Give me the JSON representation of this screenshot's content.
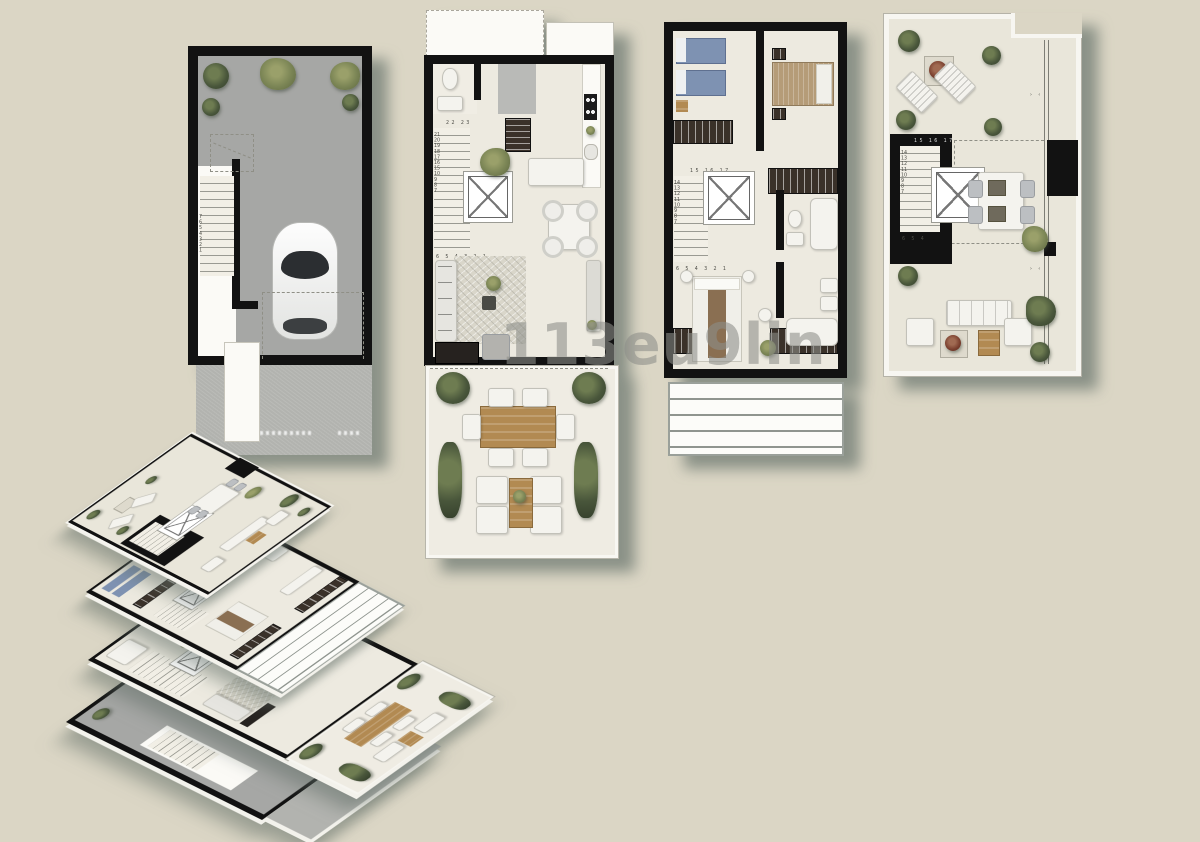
{
  "title": "townhouse-floor-plans",
  "watermark": {
    "text": "113eu9lin"
  },
  "colors": {
    "background": "#dbd6c5",
    "walls": "#121212",
    "floor": "#edeae0",
    "garage_floor": "#a6a7a5",
    "driveway": "#b2b3af",
    "shadow": "#5f6e68",
    "bed_blue": "#7e92b2",
    "bed_tan": "#b59c78",
    "wood": "#b28a52",
    "plant_dark": "#49563b",
    "terrace_floor": "#efece3"
  },
  "plans": {
    "basement": {
      "stair_left": [
        "7",
        "6",
        "5",
        "4",
        "3",
        "2",
        "1"
      ]
    },
    "ground": {
      "stair_top": [
        "22",
        "23"
      ],
      "stair_left": [
        "21",
        "20",
        "19",
        "18",
        "17",
        "16",
        "15",
        "10",
        "9",
        "8",
        "7"
      ],
      "stair_bottom": [
        "6",
        "5",
        "4",
        "3",
        "2",
        "1"
      ]
    },
    "first": {
      "stair_top": [
        "15",
        "16",
        "17"
      ],
      "stair_left": [
        "14",
        "13",
        "12",
        "11",
        "10",
        "9",
        "8",
        "7"
      ],
      "stair_bottom": [
        "6",
        "5",
        "4",
        "3",
        "2",
        "1"
      ]
    },
    "solarium": {
      "stair_top": [
        "15",
        "16",
        "17"
      ],
      "stair_left": [
        "14",
        "13",
        "12",
        "11",
        "10",
        "9",
        "8",
        "7"
      ],
      "stair_bottom": [
        "6",
        "5",
        "4"
      ],
      "rail_chevrons": "› ‹"
    }
  }
}
